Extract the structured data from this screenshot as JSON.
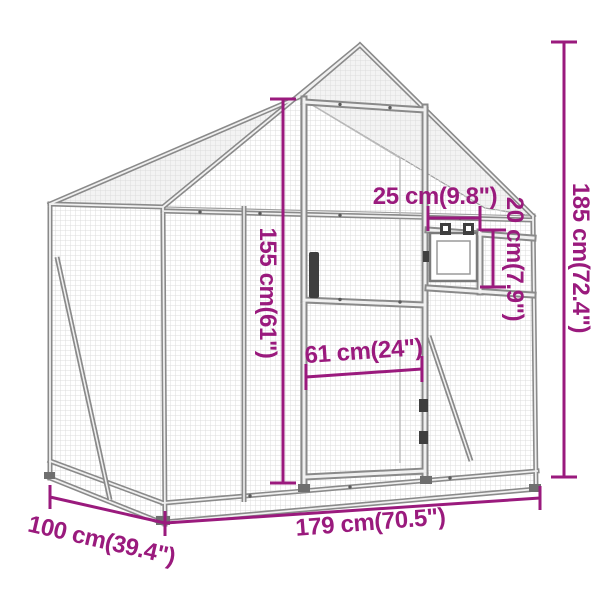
{
  "diagram": {
    "type": "product-dimension-diagram",
    "subject": "wireframe aviary / mesh coop with gable roof, door and small window",
    "accent_color": "#9A1A7D",
    "frame_color": "#8a8a8a",
    "mesh_color": "#dcdcdc",
    "background_color": "#ffffff",
    "dimensions": {
      "door_height": "155 cm(61\")",
      "overall_height": "185 cm(72.4\")",
      "window_width": "25 cm(9.8\")",
      "window_height": "20 cm(7.9\")",
      "door_width": "61 cm(24\")",
      "overall_width": "179 cm(70.5\")",
      "depth": "100 cm(39.4\")"
    }
  }
}
